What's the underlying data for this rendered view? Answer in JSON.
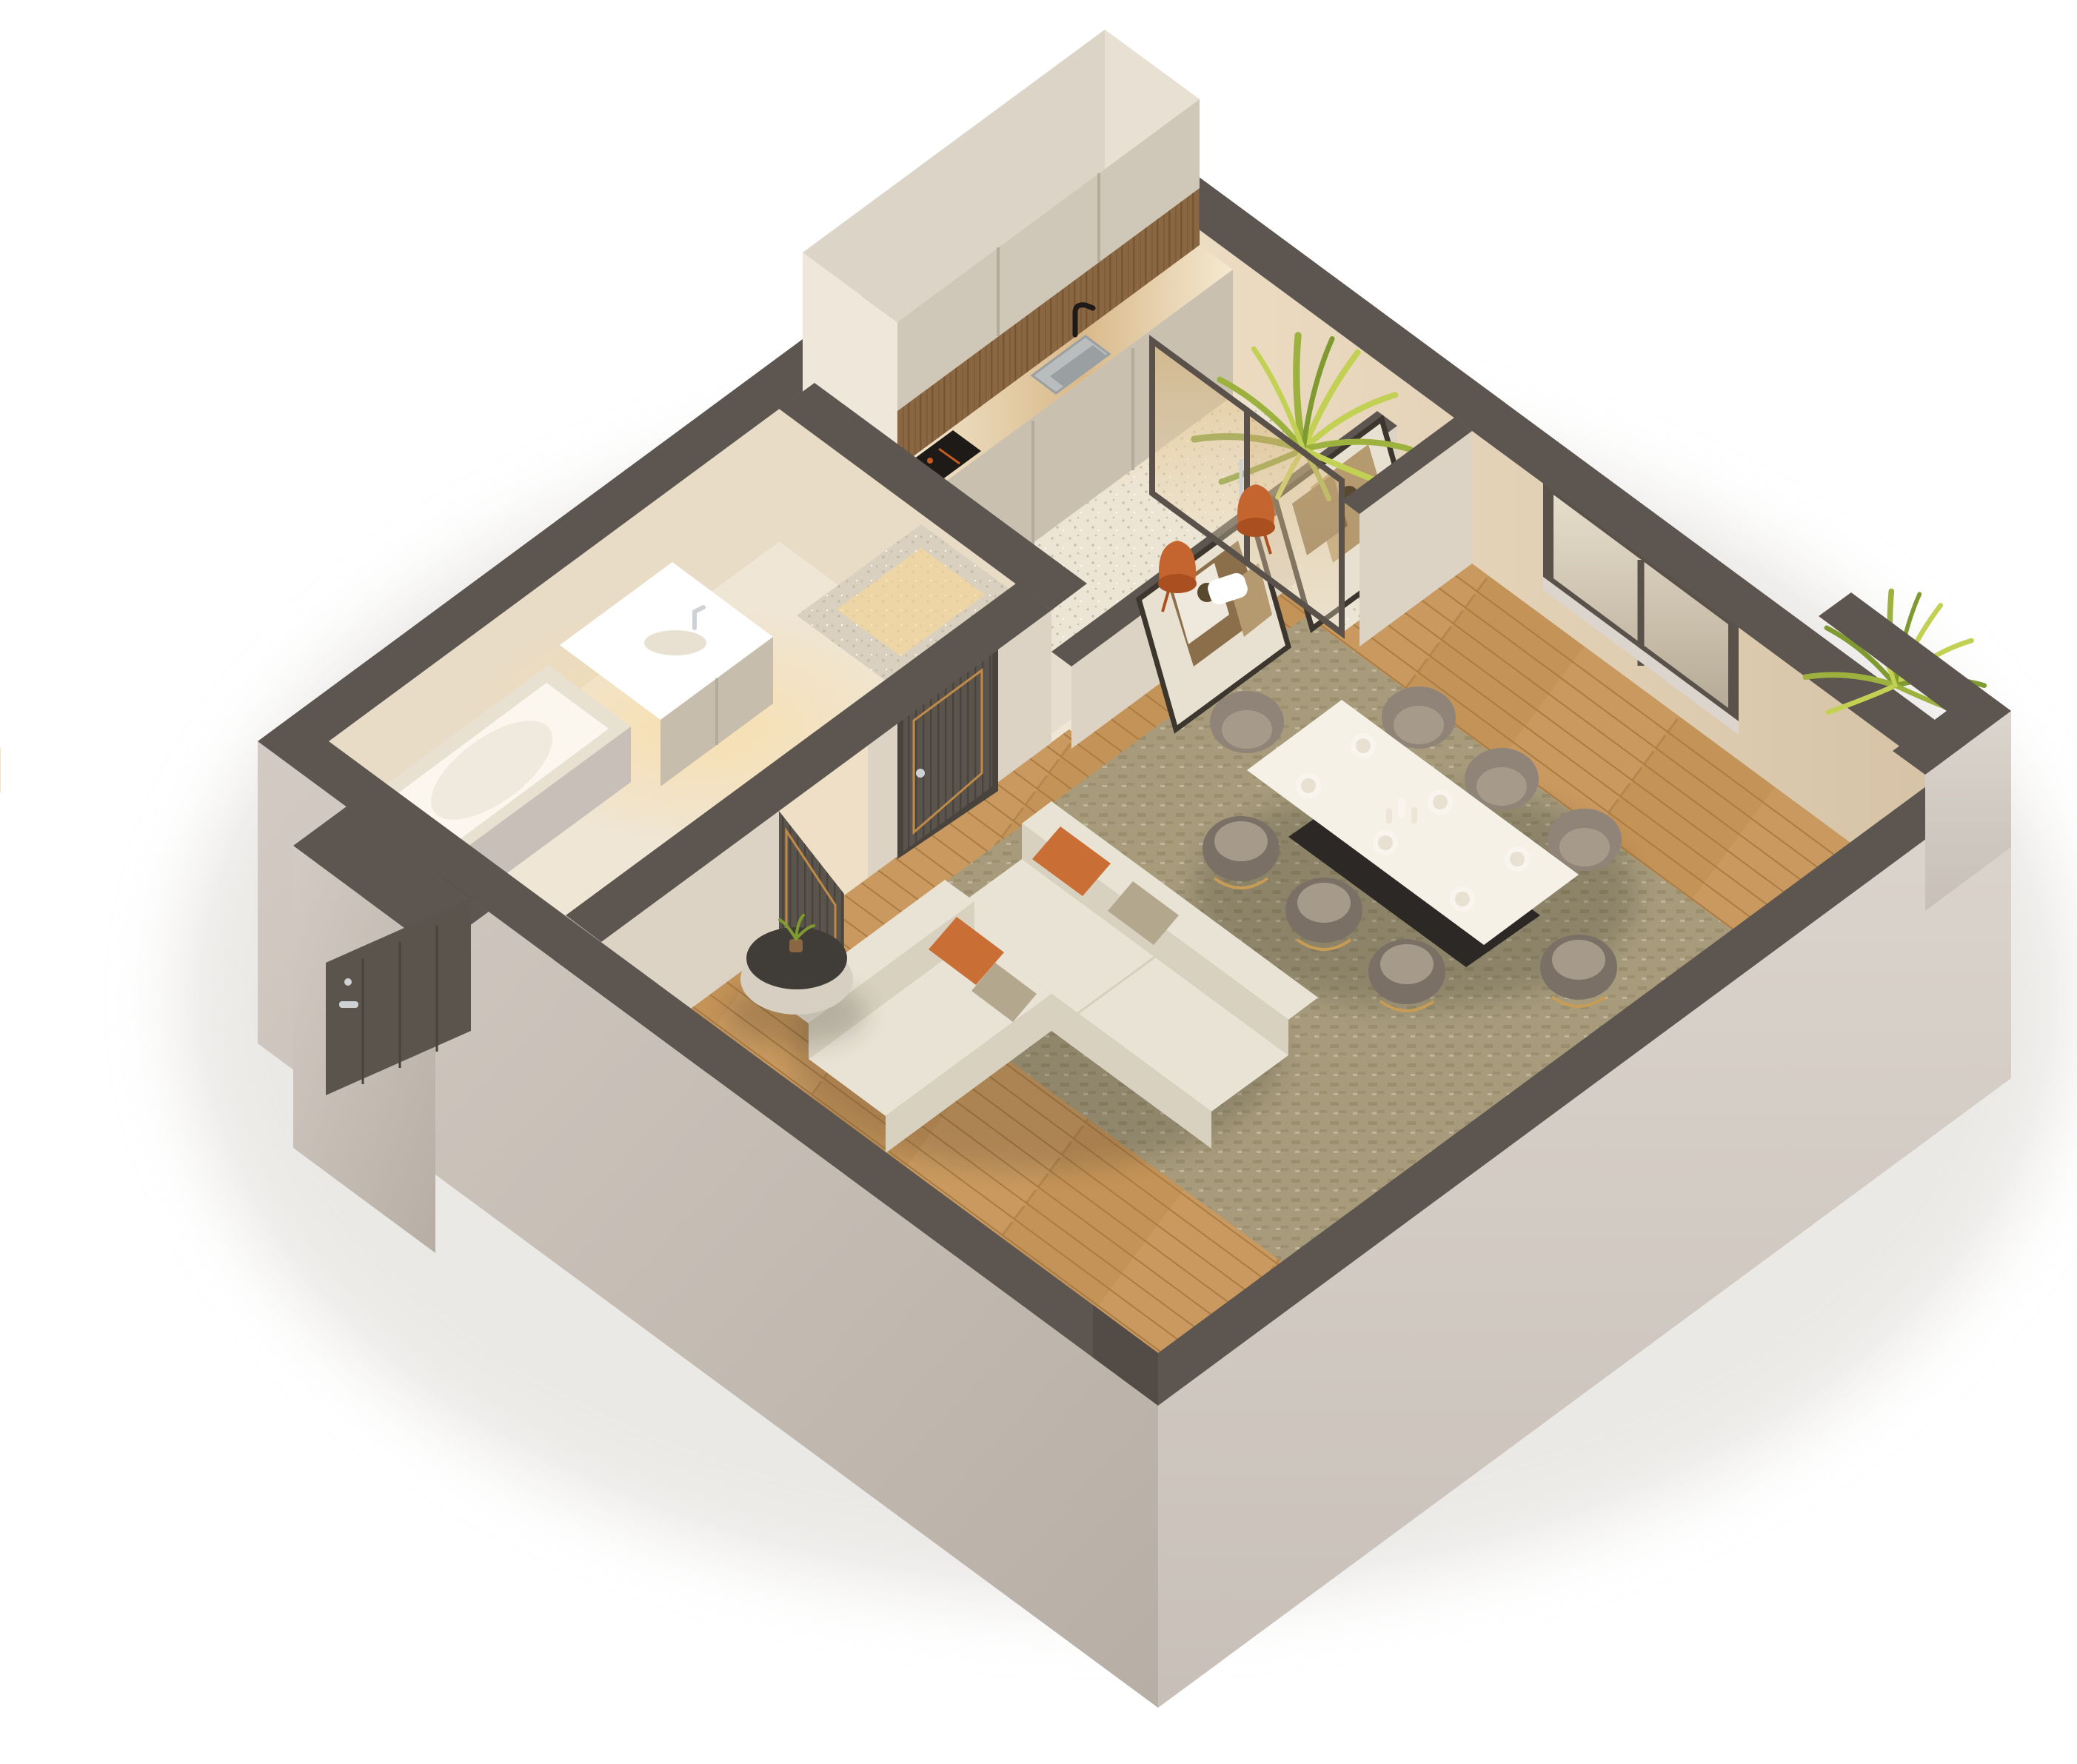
{
  "scene": {
    "type": "isometric-3d-floor-plan",
    "description": "3D cutaway render of a small apartment viewed from above",
    "rooms": [
      "kitchen",
      "balcony-niche",
      "bathroom",
      "hallway",
      "living-room",
      "dining-area",
      "entry-porch"
    ],
    "counts": {
      "interior_doors": 2,
      "entry_doors": 1,
      "dining_chairs": 8,
      "accent_chairs": 2,
      "place_settings": 6,
      "artworks": 2,
      "plants": 3,
      "windows": 1,
      "glass_panels": 2,
      "sofas": 2,
      "pillows": 4
    }
  },
  "colors": {
    "bg": "#ffffff",
    "groundShadow": "#d8d4cf",
    "wallTop": "#5d5650",
    "wallTopDk": "#524b46",
    "extSE1": "#dcd5cd",
    "extSE2": "#c8c0b8",
    "extSW1": "#d3cbc3",
    "extSW2": "#b7aea5",
    "intNE1": "#efdfc6",
    "intNE2": "#d6c3a6",
    "intNW1": "#e9dcc6",
    "woodA": "#c9995f",
    "woodB": "#bf8d52",
    "woodSeam": "#a97c45",
    "terrA": "#ece4d4",
    "terrDot": "#c9bda6",
    "terrDot2": "#ffffff",
    "bathFloor": "#efe6d6",
    "rugA": "#a79b7c",
    "rugB": "#8e8263",
    "lowFace": "#ddd3c4",
    "lowFaceLt": "#e7ddcf",
    "cabTop": "#dbd4c7",
    "cabNE": "#e7e0d3",
    "cabSW": "#eee7da",
    "cabFace": "#cfc7b8",
    "cabSeam": "#b5ab9a",
    "woodBk": "#8a6742",
    "woodBkDk": "#6f4f2e",
    "counter": "#f4e9d1",
    "vein": "#d9b98a",
    "baseCab": "#c9c0b0",
    "steel": "#b9bdbe",
    "steelDk": "#9aa0a1",
    "black": "#1d1a17",
    "cookOrange": "#c35b22",
    "glass1": "#d8b57a",
    "glass2": "#f1e2c2",
    "frame": "#5a524a",
    "fernA": "#9db23e",
    "fernB": "#c2d153",
    "fernC": "#7e9a30",
    "win1": "#e6ddcb",
    "win2": "#b6ab96",
    "artFrame": "#3c362f",
    "artBg": "#e8e0d1",
    "artBrown": "#8a6f4a",
    "artTan": "#b49a6e",
    "artCream": "#efe8dc",
    "artDark": "#59492f",
    "door": "#5b544d",
    "doorFlute": "#49433d",
    "gold": "#c08a48",
    "silver": "#cfd2d4",
    "stone": "#d9d0bf",
    "stoneDk": "#c4baa7",
    "white": "#ffffff",
    "tub": "#fbf7ee",
    "tubEdge": "#e8e1d2",
    "vanFront": "#c7bdac",
    "tableTop": "#f6f1e7",
    "tableBase": "#2c2825",
    "chair": "#8f8477",
    "chairDk": "#7a7065",
    "chairIn": "#a69b8b",
    "goldLeg": "#c79c55",
    "sofa": "#e9e3d5",
    "sofaDk": "#d8d1c0",
    "sofaLn": "#cfc7b4",
    "pillO": "#c96f35",
    "pillT": "#b3a78e",
    "cofTop": "#403c38",
    "cofBase": "#d7d0c2",
    "tv": "#15120f",
    "entryDark": "#3a342e",
    "plate": "#f8f5ee",
    "orange": "#c4642e",
    "orangeDk": "#a94f20",
    "glow": "#ffd98f"
  }
}
